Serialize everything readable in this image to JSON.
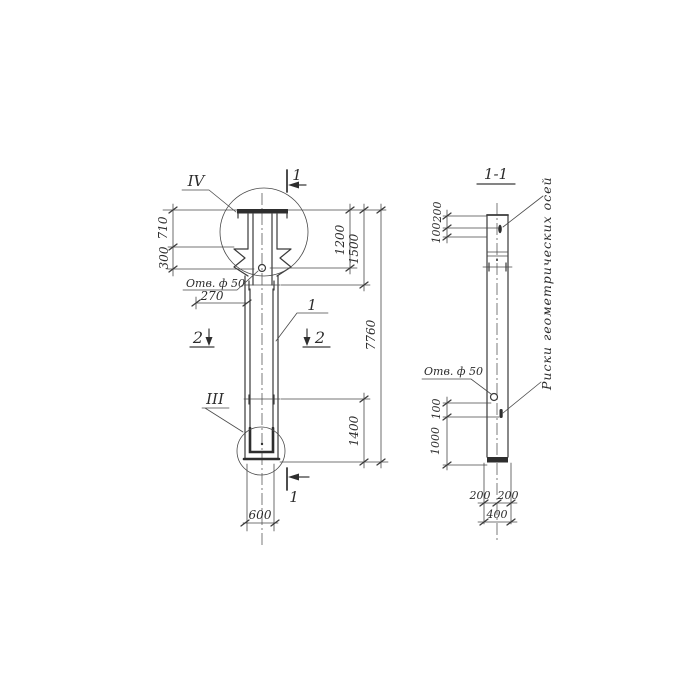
{
  "drawing": {
    "main_view": {
      "detail_iv": "IV",
      "detail_iii": "III",
      "section1_top": "1",
      "section1_bottom": "1",
      "section2_left": "2",
      "section2_right": "2",
      "part_leader": "1",
      "hole_label": "Отв. ф 50",
      "dim_710": "710",
      "dim_300": "300",
      "dim_270": "270",
      "dim_1200": "1200",
      "dim_1500": "1500",
      "dim_7760": "7760",
      "dim_1400": "1400",
      "dim_600": "600"
    },
    "section_view": {
      "title": "1-1",
      "hole_label": "Отв. ф 50",
      "axes_note": "Риски геометрических осей",
      "dim_200_top": "200",
      "dim_100_top": "100",
      "dim_100_mid": "100",
      "dim_1000": "1000",
      "dim_200_left": "200",
      "dim_200_right": "200",
      "dim_400": "400"
    }
  }
}
